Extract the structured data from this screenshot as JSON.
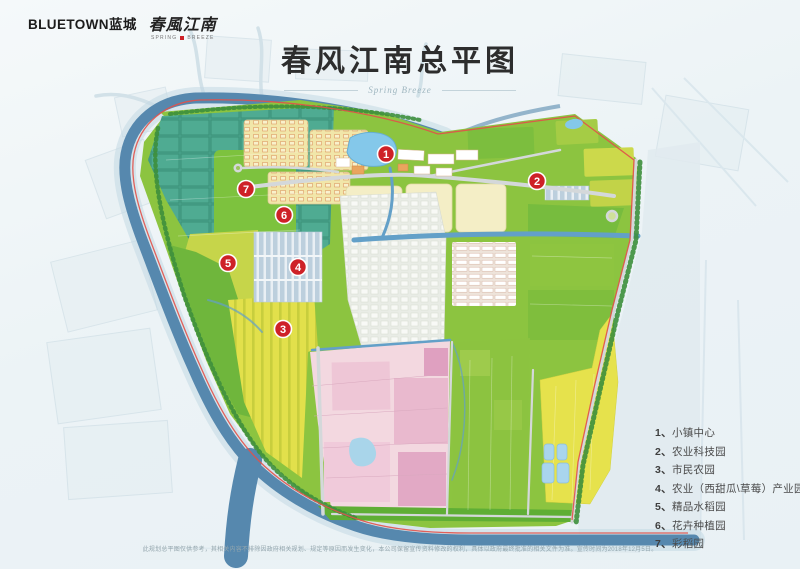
{
  "header": {
    "logo_primary": "BLUETOWN蓝城",
    "logo_calligraphy": "春風江南",
    "logo_tagline_left": "SPRING",
    "logo_tagline_right": "BREEZE",
    "title": "春风江南总平图",
    "title_script": "Spring Breeze"
  },
  "legend": {
    "items": [
      {
        "num": "1",
        "label": "小镇中心"
      },
      {
        "num": "2",
        "label": "农业科技园"
      },
      {
        "num": "3",
        "label": "市民农园"
      },
      {
        "num": "4",
        "label": "农业（西甜瓜\\草莓）产业园"
      },
      {
        "num": "5",
        "label": "精品水稻园"
      },
      {
        "num": "6",
        "label": "花卉种植园"
      },
      {
        "num": "7",
        "label": "彩稻园"
      }
    ]
  },
  "markers": [
    {
      "label": "1",
      "x": 386,
      "y": 154
    },
    {
      "label": "2",
      "x": 537,
      "y": 181
    },
    {
      "label": "3",
      "x": 283,
      "y": 329
    },
    {
      "label": "4",
      "x": 298,
      "y": 267
    },
    {
      "label": "5",
      "x": 228,
      "y": 263
    },
    {
      "label": "6",
      "x": 284,
      "y": 215
    },
    {
      "label": "7",
      "x": 246,
      "y": 189
    }
  ],
  "footer": {
    "disclaimer": "此规划总平图仅供参考，其相关内容不排除因政府相关规划、规定等原因而发生变化，本公司保留宣传资料修改的权利，具体以政府最终批准的相关文件为准。宣传时间为2018年12月5日。"
  },
  "palette": {
    "marker_red": "#ce2127",
    "river_blue": "#5688ae",
    "site_green": "#8cc440",
    "accent_red_line": "#e2514a",
    "legend_text": "#4a4a4a"
  }
}
